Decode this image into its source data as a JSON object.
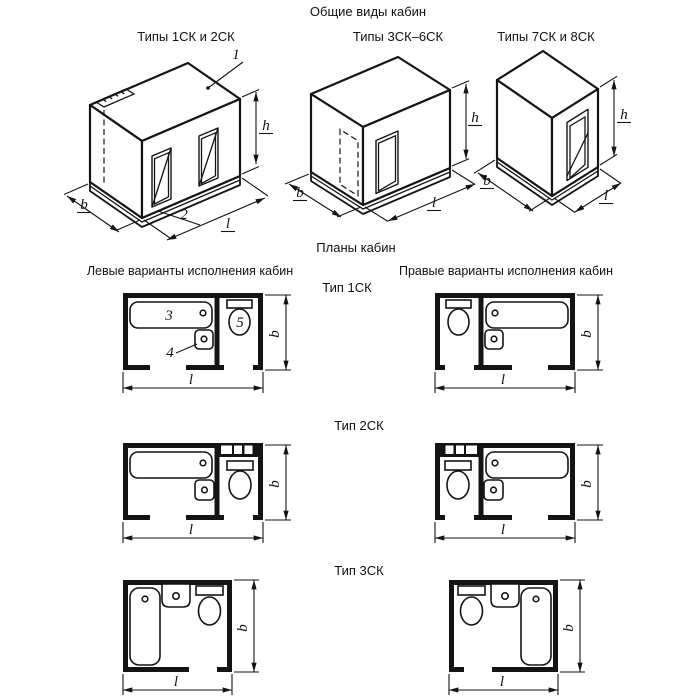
{
  "title": "Общие виды кабин",
  "views": [
    {
      "label": "Типы 1СК и 2СК"
    },
    {
      "label": "Типы 3СК–6СК"
    },
    {
      "label": "Типы 7СК и 8СК"
    }
  ],
  "plans": {
    "title": "Планы кабин",
    "left_column": "Левые варианты исполнения кабин",
    "right_column": "Правые варианты исполнения кабин",
    "rows": [
      {
        "label": "Тип 1СК"
      },
      {
        "label": "Тип 2СК"
      },
      {
        "label": "Тип 3СК"
      }
    ]
  },
  "dims": {
    "height": "h",
    "width": "b",
    "length": "l"
  },
  "callouts": {
    "roof_panel": "1",
    "base": "2",
    "bathtub": "3",
    "washbasin": "4",
    "toilet": "5"
  },
  "colors": {
    "line": "#141414",
    "background": "#ffffff"
  }
}
